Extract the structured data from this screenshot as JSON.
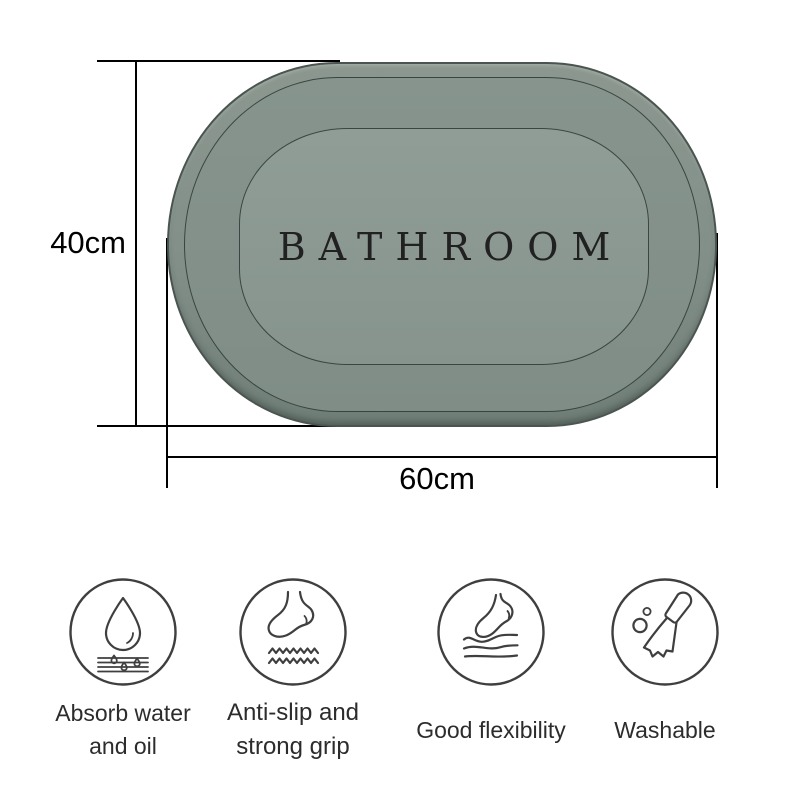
{
  "mat": {
    "text": "BATHROOM"
  },
  "dimensions": {
    "height_label": "40cm",
    "width_label": "60cm"
  },
  "features": [
    {
      "label": "Absorb water and oil",
      "icon": "water-drop-layers-icon"
    },
    {
      "label": "Anti-slip and strong grip",
      "icon": "foot-zigzag-icon"
    },
    {
      "label": "Good flexibility",
      "icon": "foot-flex-icon"
    },
    {
      "label": "Washable",
      "icon": "cleaning-brush-icon"
    }
  ],
  "colors": {
    "mat-outer-top": "#8b978f",
    "mat-outer-bottom": "#707e78",
    "mat-middle": "#87948e",
    "mat-inner": "#909d97",
    "mat-line": "#4a554f",
    "mat-text": "#212121",
    "dimension": "#000000",
    "icon-stroke": "#3f3f3f",
    "label-text": "#2c2c2c"
  }
}
